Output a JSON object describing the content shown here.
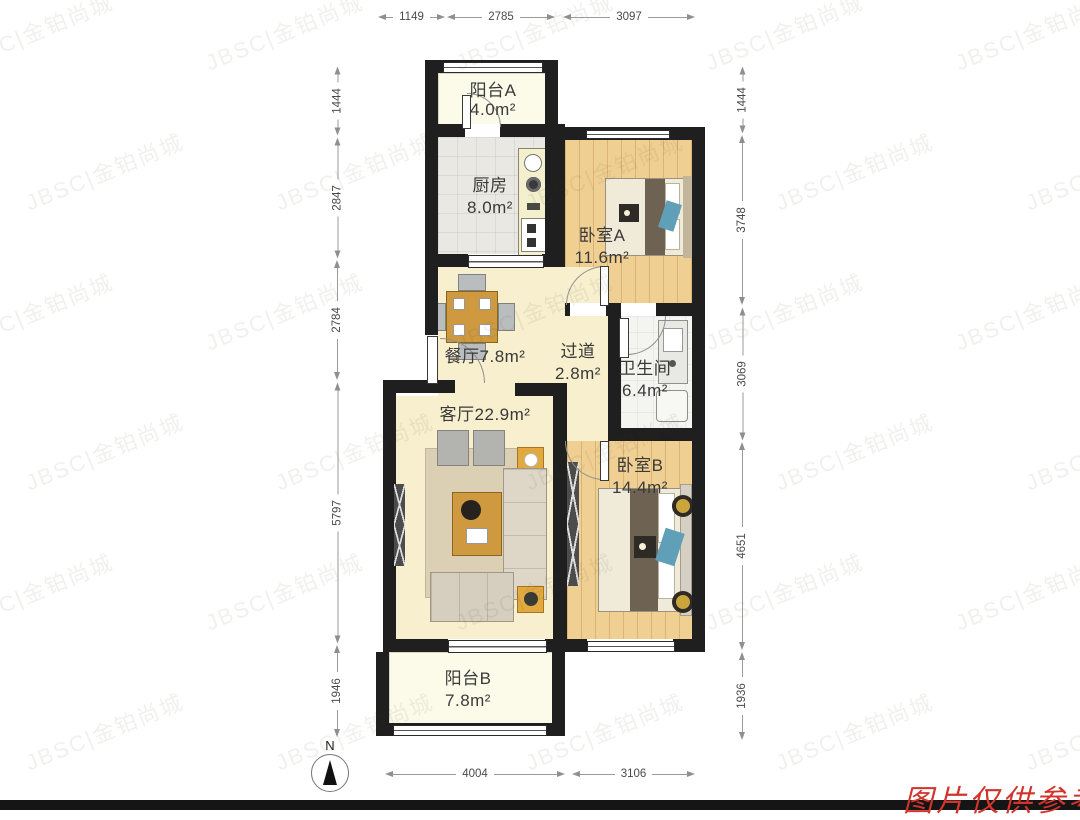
{
  "meta": {
    "watermark": "JBSC|金铂尚城",
    "notice": {
      "text": "图片仅供参考",
      "color": "#d0342c"
    },
    "north_label": "N",
    "colors": {
      "wall": "#1f1f1f",
      "wood_floor": "#f0cf93",
      "cream_floor": "#f7efcd",
      "accent_teal": "#5f9fb8",
      "table_wood": "#cf9a3f",
      "dim_line": "#9a9a9a"
    }
  },
  "rooms": [
    {
      "id": "balcony_a",
      "name": "阳台A",
      "area": "4.0m²"
    },
    {
      "id": "kitchen",
      "name": "厨房",
      "area": "8.0m²"
    },
    {
      "id": "bedroom_a",
      "name": "卧室A",
      "area": "11.6m²"
    },
    {
      "id": "dining",
      "name": "餐厅",
      "area": "7.8m²"
    },
    {
      "id": "hallway",
      "name": "过道",
      "area": "2.8m²"
    },
    {
      "id": "bathroom",
      "name": "卫生间",
      "area": "6.4m²"
    },
    {
      "id": "living",
      "name": "客厅",
      "area": "22.9m²"
    },
    {
      "id": "bedroom_b",
      "name": "卧室B",
      "area": "14.4m²"
    },
    {
      "id": "balcony_b",
      "name": "阳台B",
      "area": "7.8m²"
    }
  ],
  "dimensions": {
    "top": [
      "1149",
      "2785",
      "3097"
    ],
    "left": [
      "1444",
      "2847",
      "2784",
      "5797",
      "1946"
    ],
    "right": [
      "1444",
      "3748",
      "3069",
      "4651",
      "1936"
    ],
    "bottom": [
      "4004",
      "3106"
    ]
  }
}
